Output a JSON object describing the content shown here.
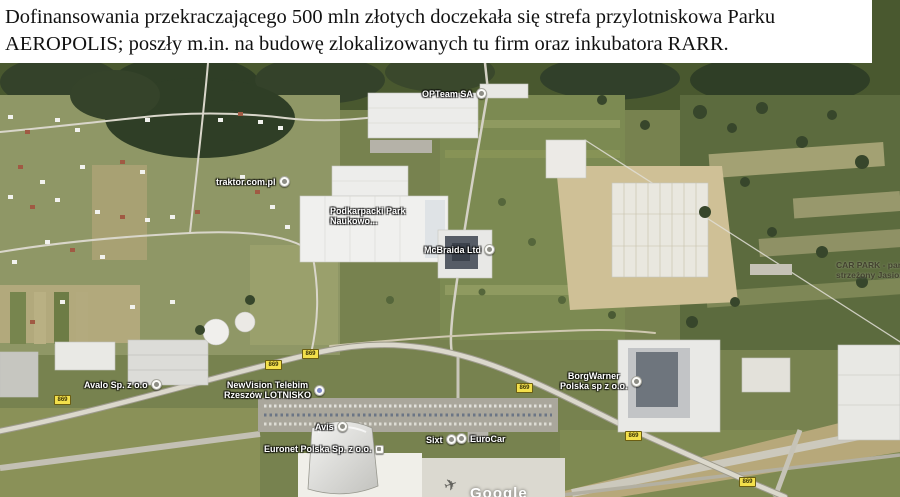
{
  "header": {
    "line1": "Dofinansowania przekraczającego 500 mln złotych doczekała się strefa przylotniskowa Parku",
    "line2": "AEROPOLIS; poszły m.in. na budowę zlokalizowanych tu firm oraz inkubatora RARR."
  },
  "map": {
    "road_badge_label": "869",
    "watermark": "Google",
    "pois": [
      {
        "line1": "OPTeam SA"
      },
      {
        "line1": "traktor.com.pl"
      },
      {
        "line1": "Podkarpacki Park",
        "line2": "Naukowo..."
      },
      {
        "line1": "McBraida Ltd"
      },
      {
        "line1": "CAR PARK - parking",
        "line2": "strzeżony Jasionka"
      },
      {
        "line1": "Avalo Sp. z o.o"
      },
      {
        "line1": "NewVision Telebim",
        "line2": "Rzeszów LOTNISKO"
      },
      {
        "line1": "BorgWarner",
        "line2": "Polska sp z o.o."
      },
      {
        "line1": "Avis"
      },
      {
        "line1": "Sixt"
      },
      {
        "line1": "EuroCar"
      },
      {
        "line1": "Euronet Polska Sp. z o.o."
      }
    ]
  },
  "colors": {
    "road_badge_yellow": "#f3e04b",
    "poi_text": "#ffffff",
    "carpark_text": "#43422f",
    "header_bg": "#ffffff",
    "header_text": "#111111",
    "forest_green": "#34422a",
    "field_olive": "#77824f",
    "building_white": "#ececea"
  }
}
